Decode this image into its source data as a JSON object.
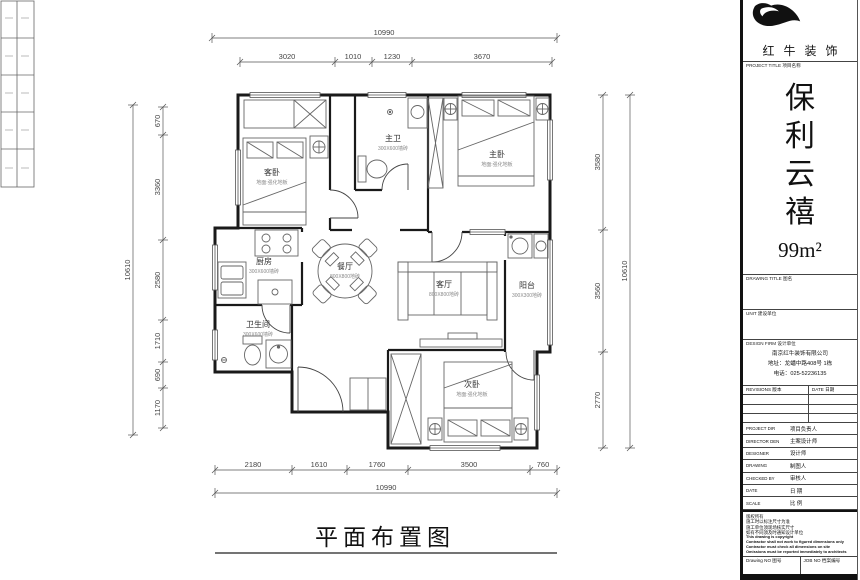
{
  "plan": {
    "title": "平面布置图",
    "rooms": {
      "guest_bedroom": {
        "name": "客卧",
        "sub": "地面:强化地板"
      },
      "master_bath": {
        "name": "主卫",
        "sub": "300X600墙砖"
      },
      "master_bedroom": {
        "name": "主卧",
        "sub": "地面:强化地板"
      },
      "kitchen": {
        "name": "厨房",
        "sub": "300X600墙砖"
      },
      "dining": {
        "name": "餐厅",
        "sub": "800X800地砖"
      },
      "living": {
        "name": "客厅",
        "sub": "800X800地砖"
      },
      "balcony": {
        "name": "阳台",
        "sub": "300X300地砖"
      },
      "bathroom": {
        "name": "卫生间",
        "sub": "300X600墙砖"
      },
      "second_bedroom": {
        "name": "次卧",
        "sub": "地面:强化地板"
      }
    },
    "dims": {
      "top_overall": "10990",
      "top_segments": [
        "3020",
        "1010",
        "1230",
        "3670"
      ],
      "bottom_segments": [
        "2180",
        "1610",
        "1760",
        "3500",
        "760"
      ],
      "bottom_overall": "10990",
      "left_overall": "10610",
      "left_segments": [
        "670",
        "3360",
        "2580",
        "1710",
        "690",
        "1170"
      ],
      "right_segments": [
        "3580",
        "3560",
        "2770"
      ],
      "right_overall": "10610"
    }
  },
  "title_block": {
    "brand": "红牛装饰",
    "project_label": "PROJECT TITLE  项目名称",
    "project_chars": [
      "保",
      "利",
      "云",
      "禧"
    ],
    "area": "99m²",
    "drawing_title_label": "DRAWING TITLE  图名",
    "unit_label": "UNIT  建设单位",
    "design_firm_label": "DESIGN FIRM  设计单位",
    "firm_name": "南京红牛装饰有限公司",
    "firm_address": "地址：龙蟠中路408号 1栋",
    "firm_phone": "电话：025-52236135",
    "revisions_label": "REVISIONS  版本",
    "date_label": "DATE  日期",
    "personnel_rows": [
      {
        "en": "PROJECT DIR",
        "cn": "项目负责人"
      },
      {
        "en": "DIRECTOR DEN",
        "cn": "主案设计师"
      },
      {
        "en": "DESIGNER",
        "cn": "设计师"
      },
      {
        "en": "DRAWING",
        "cn": "制图人"
      },
      {
        "en": "CHECKED BY",
        "cn": "审核人"
      },
      {
        "en": "DATE",
        "cn": "日 期"
      },
      {
        "en": "SCALE",
        "cn": "比 例"
      }
    ],
    "notes": [
      "版权所有",
      "施工时以标注尺寸为准",
      "施工单位须现场核实尺寸",
      "如有不同须及时通知设计单位",
      "This drawing is copyright",
      "Contractor shall not work to figured dimensions only",
      "Contractor must check all dimensions on site",
      "Omissions must be reported immediately to architects"
    ],
    "drawing_no_label": "Drawing NO  图号",
    "job_no_label": "JOB NO  档案编号"
  }
}
